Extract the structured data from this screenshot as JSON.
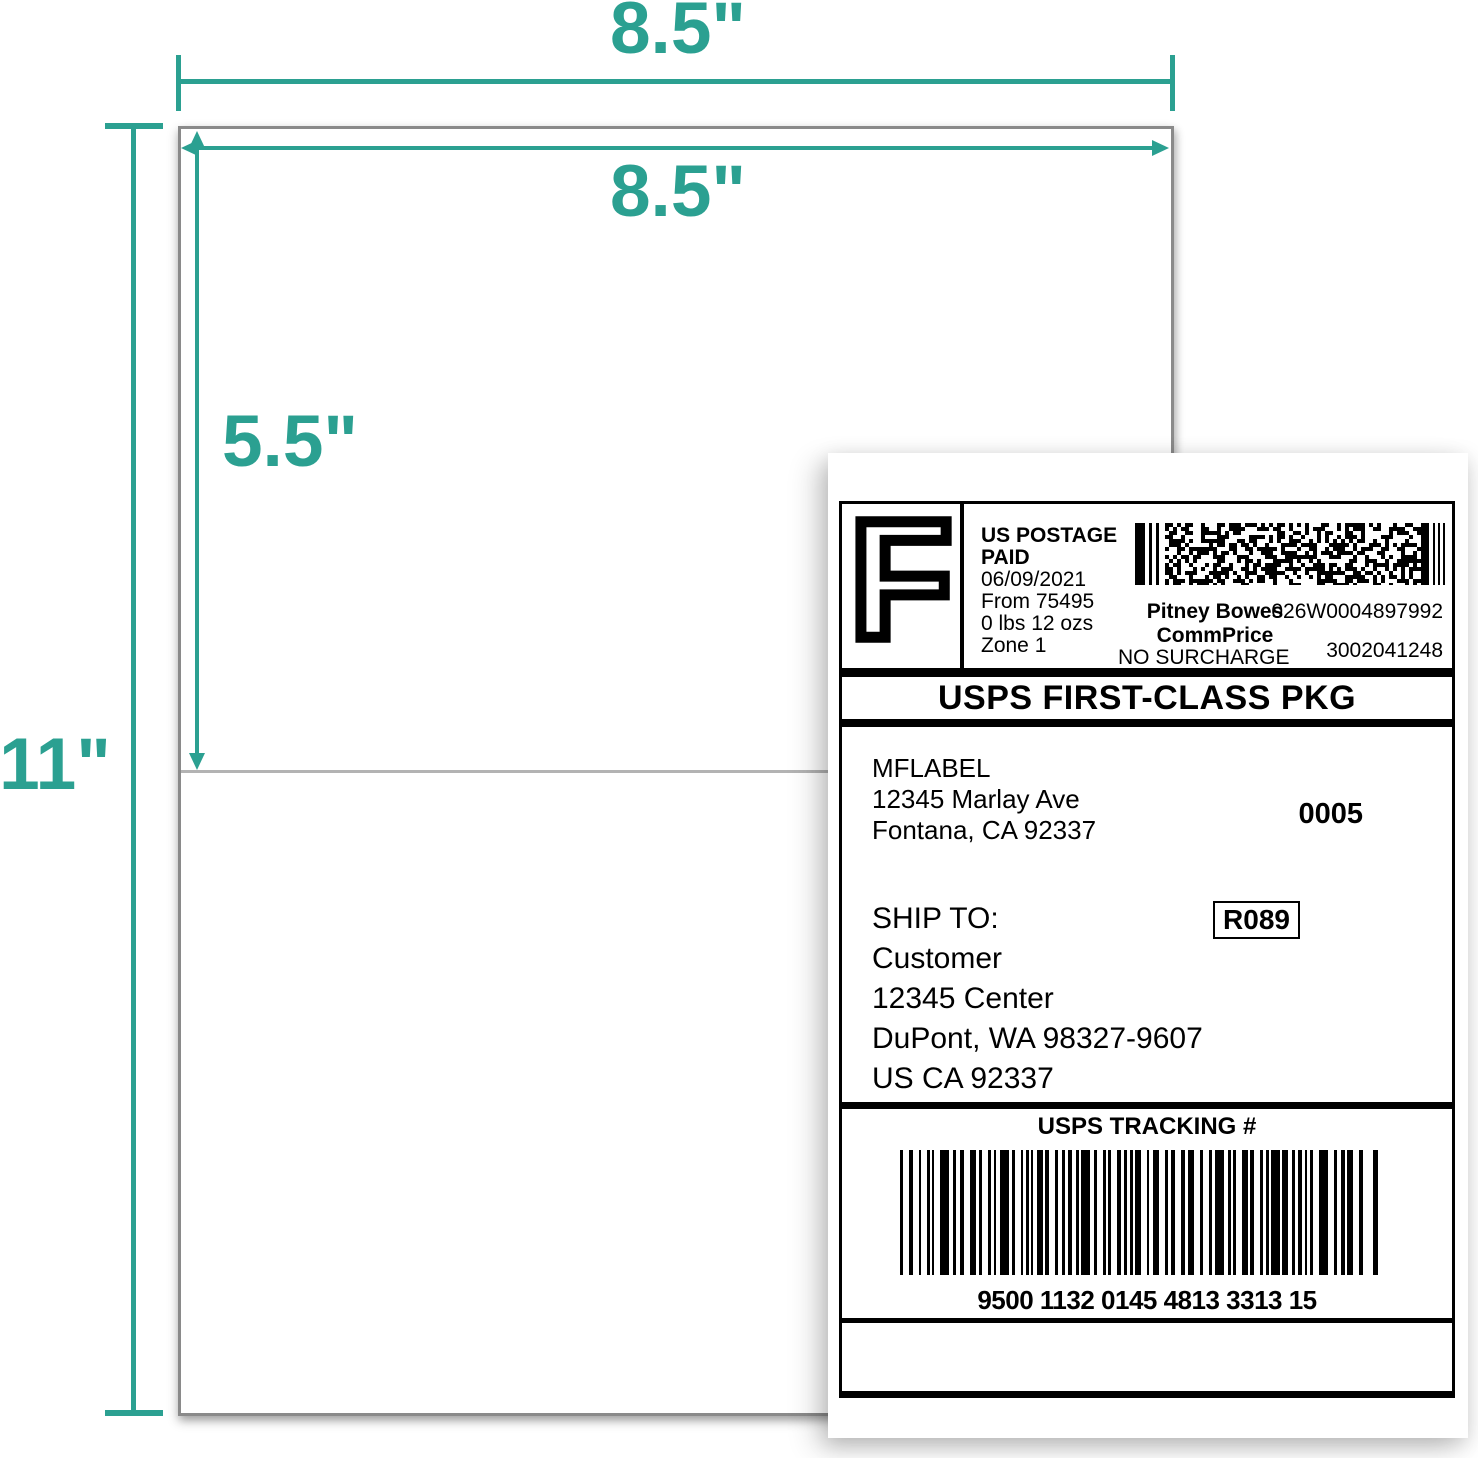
{
  "colors": {
    "accent": "#2ba091",
    "sheet_border": "#8a8a8a",
    "divider_line": "#b3b3b3",
    "label_ink": "#000000"
  },
  "dimensions": {
    "sheet_width": "8.5\"",
    "label_width": "8.5\"",
    "label_height": "5.5\"",
    "sheet_height": "11\""
  },
  "label": {
    "postage": {
      "indicia": "F",
      "paid_statement": "US POSTAGE PAID",
      "date": "06/09/2021",
      "origin": "From 75495",
      "weight": "0 lbs 12 ozs",
      "zone": "Zone 1",
      "vendor": "Pitney Bowes",
      "meter_id": "026W0004897992",
      "rate_type": "CommPrice",
      "surcharge": "NO SURCHARGE",
      "serial": "3002041248"
    },
    "service": "USPS FIRST-CLASS PKG",
    "sender": {
      "name": "MFLABEL",
      "street": "12345 Marlay Ave",
      "city": "Fontana, CA 92337"
    },
    "batch_number": "0005",
    "ship_to": {
      "heading": "SHIP TO:",
      "name": "Customer",
      "street": "12345 Center",
      "city": "DuPont, WA 98327-9607",
      "country_line": "US CA 92337"
    },
    "route_code": "R089",
    "tracking": {
      "heading": "USPS TRACKING #",
      "number": "9500 1132 0145 4813 3313 15"
    }
  }
}
